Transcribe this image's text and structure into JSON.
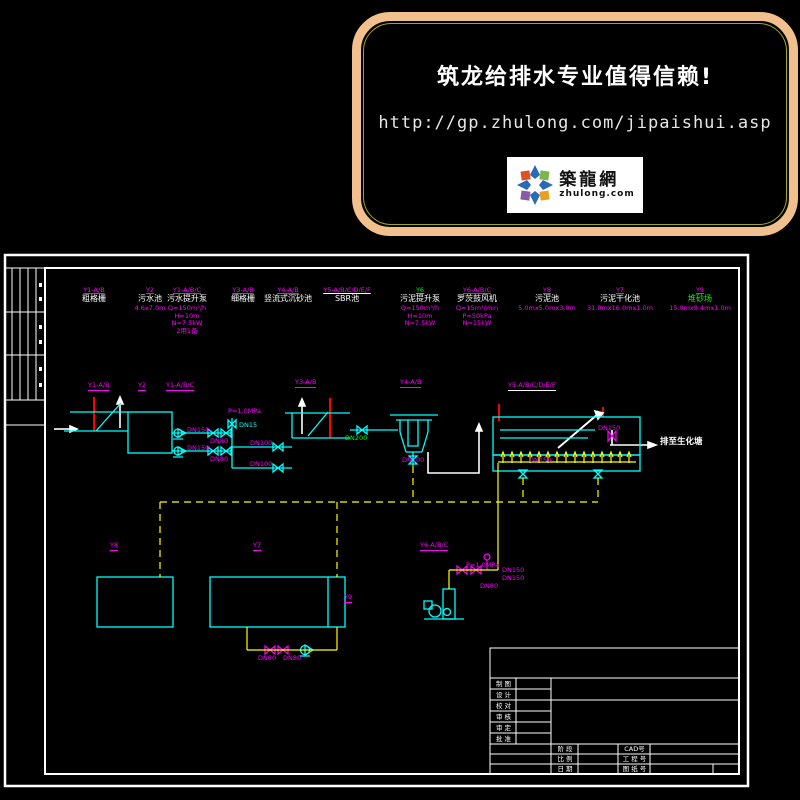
{
  "banner": {
    "title": "筑龙给排水专业值得信赖!",
    "url": "http://gp.zhulong.com/jipaishui.asp",
    "logo_name": "築龍網",
    "logo_domain": "zhulong.com"
  },
  "colors": {
    "line_cyan": "#00ffff",
    "pipe_yellow": "#ffff00",
    "label_magenta": "#ff00ff",
    "accent_green": "#00ff00",
    "screen_red": "#ff0000",
    "frame_white": "#ffffff",
    "banner_border": "#f2c08c"
  },
  "equipment": [
    {
      "tag": "Y1-A/B",
      "name": "粗格栅",
      "specs": ""
    },
    {
      "tag": "Y2",
      "name": "污水池",
      "specs": "4.6x7.0m"
    },
    {
      "tag": "Y1-A/B/C",
      "name": "污水提升泵",
      "specs": "Q=150m³/h\nH=10m\nN=7.5kW\n2用1备"
    },
    {
      "tag": "Y3-A/B",
      "name": "细格栅",
      "specs": ""
    },
    {
      "tag": "Y4-A/B",
      "name": "竖流式沉砂池",
      "specs": ""
    },
    {
      "tag": "Y5-A/B/C/D/E/F",
      "name": "SBR池",
      "specs": ""
    },
    {
      "tag": "Y6",
      "name": "污泥提升泵",
      "specs": "Q=150m³/h\nH=10m\nN=7.5kW"
    },
    {
      "tag": "Y6-A/B/C",
      "name": "罗茨鼓风机",
      "specs": "Q=15m³/min\nP=50kPa\nN=15kW"
    },
    {
      "tag": "Y8",
      "name": "污泥池",
      "specs": "5.0mx5.0mx3.0m"
    },
    {
      "tag": "Y7",
      "name": "污泥干化池",
      "specs": "31.0mx16.0mx1.0m"
    },
    {
      "tag": "Y9",
      "name": "堆砂场",
      "specs": "15.0mx9.4mx1.0m"
    }
  ],
  "labels": {
    "tag_y1ab": "Y1-A/B",
    "tag_y2": "Y2",
    "tag_y1abc": "Y1-A/B/C",
    "tag_y3ab": "Y3-A/B",
    "tag_y4ab": "Y4-A/B",
    "tag_y5": "Y5-A/B/C/D/E/F",
    "tag_y6abc": "Y6-A/B/C",
    "tag_y8": "Y8",
    "tag_y7": "Y7",
    "tag_y9": "Y9",
    "pressure": "P=1.0MPa",
    "dn15": "DN15",
    "pump1_dn": "DN150",
    "pump2_dn": "DN150",
    "valve1_dn": "DN80",
    "valve2_dn": "DN80",
    "branch1_dn": "DN100",
    "branch2_dn": "DN100",
    "screen_valve_dn": "DN200",
    "grit_drain_dn": "DN100",
    "sbr_drain_dn": "DN150",
    "decant_dn": "DN150",
    "blower_p": "P=1.0MPa",
    "blower_dn150a": "DN150",
    "blower_dn150b": "DN150",
    "blower_dn80": "DN80",
    "sludge_dn80a": "DN80",
    "sludge_dn80b": "DN80",
    "outfall": "排至生化塘"
  },
  "titleblock": {
    "rows": [
      "制 图",
      "设 计",
      "校 对",
      "审 核",
      "审 定",
      "批 准"
    ],
    "stage": "阶 段",
    "scale": "比 例",
    "date": "日 期",
    "cad": "CAD号",
    "project": "工 程 号",
    "drawing": "图 纸 号"
  }
}
